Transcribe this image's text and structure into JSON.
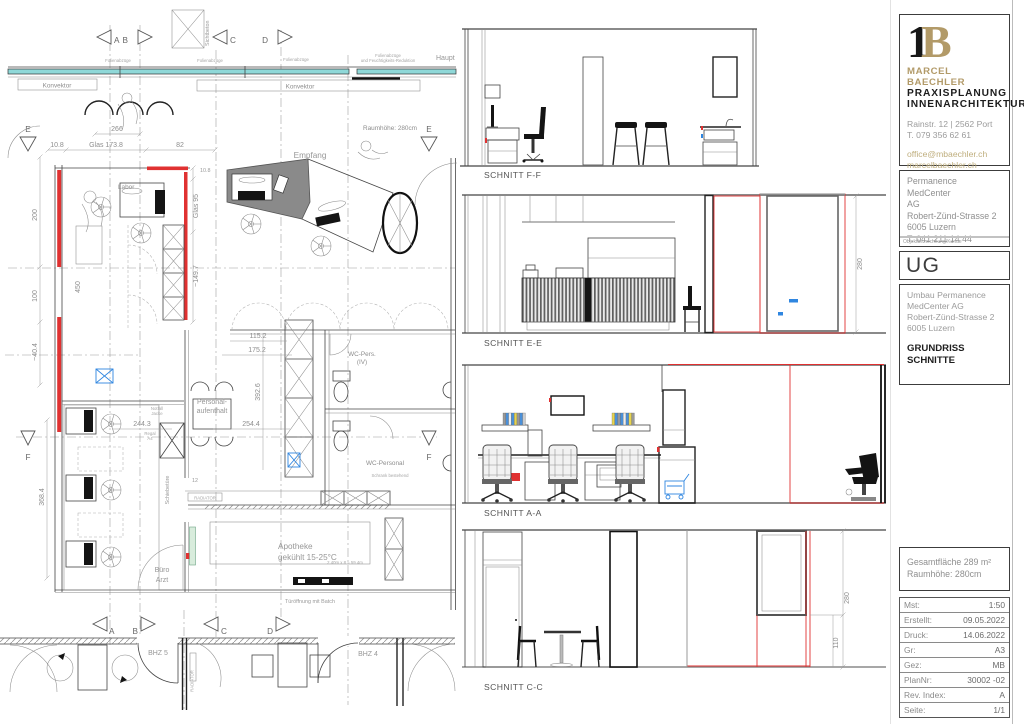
{
  "colors": {
    "accent_red": "#e03131",
    "window_teal": "#8fd8d8",
    "brand_gold": "#b29a68",
    "mark_blue": "#2f86e0"
  },
  "plan": {
    "markers": {
      "a": "A",
      "b": "B",
      "c": "C",
      "d": "D",
      "e": "E",
      "f": "F"
    },
    "labels": {
      "sichtbeton": "Sichtbeton",
      "folienabzuege": "Folienabzüge",
      "folien_sub": "und Feuchtigkeits-Reduktion",
      "haupt": "Haupt",
      "konvektor": "Konvektor",
      "raumhoehe": "Raumhöhe: 280cm",
      "empfang": "Empfang",
      "labor": "Labor",
      "personal_1": "Personal-",
      "personal_2": "aufenthalt",
      "wc_pers": "WC-Pers.",
      "wc_iv": "(IV)",
      "wc_personal": "WC-Personal",
      "schrank_bestehend": "Schrank bestehend",
      "schiebetuere": "Schiebetüre",
      "nr_12": "12",
      "radiator": "RADIATOR",
      "notfall_1": "Notfall",
      "notfall_2": "Jacke",
      "regal_1": "Regal",
      "regal_2": "A4",
      "buero_1": "Büro",
      "buero_2": "Arzt",
      "apotheke_1": "Apotheke",
      "apotheke_2": "gekühlt 15-25°C",
      "apotheke_calc": "2.40m x 8 = 59.4m",
      "tueroeffnung": "Türöffnung mit Batch",
      "bhz5": "BHZ 5",
      "bhz4": "BHZ 4"
    },
    "dims": {
      "d266": "266",
      "glas173": "Glas 173.8",
      "d108": "10.8",
      "d82": "82",
      "d108b": "10.8",
      "glas95": "Glas 95",
      "d1497": "~149.7",
      "d200": "200",
      "d100": "100",
      "d404": "~40.4",
      "d450": "450",
      "d3684": "368.4",
      "d2443": "244.3",
      "d1152": "115.2",
      "d1752": "175.2",
      "d3926": "392.6",
      "d2544": "254.4"
    }
  },
  "sections": {
    "ff": {
      "label": "SCHNITT F-F"
    },
    "ee": {
      "label": "SCHNITT E-E",
      "dim_height": "280"
    },
    "aa": {
      "label": "SCHNITT A-A"
    },
    "cc": {
      "label": "SCHNITT C-C",
      "dim_height": "280",
      "dim_sill": "110"
    }
  },
  "titleblock": {
    "logo_1": "1",
    "logo_b": "B",
    "firm_name": "MARCEL BAECHLER",
    "firm_line2": "PRAXISPLANUNG",
    "firm_line3": "INNENARCHITEKTUR",
    "firm_address": "Rainstr. 12 | 2562 Port",
    "firm_phone": "T. 079 356 62 61",
    "firm_email": "office@mbaechler.ch",
    "firm_web": "marcelbaechler.ch",
    "client_1": "Permanence MedCenter",
    "client_2": "AG",
    "client_3": "Robert-Zünd-Strasse 2",
    "client_4": "6005 Luzern",
    "client_5": "T: 041 211 14 44",
    "client_caption": "Objektbezeichnung/Kunde",
    "plan_code": "UG",
    "project_1": "Umbau Permanence",
    "project_2": "MedCenter AG",
    "project_3": "Robert-Zünd-Strasse 2",
    "project_4": "6005 Luzern",
    "drawing_title_1": "GRUNDRISS",
    "drawing_title_2": "SCHNITTE",
    "area_1": "Gesamtfläche 289 m²",
    "area_2": "Raumhöhe: 280cm",
    "meta": [
      {
        "label": "Mst:",
        "value": "1:50"
      },
      {
        "label": "Erstellt:",
        "value": "09.05.2022"
      },
      {
        "label": "Druck:",
        "value": "14.06.2022"
      },
      {
        "label": "Gr:",
        "value": "A3"
      },
      {
        "label": "Gez:",
        "value": "MB"
      },
      {
        "label": "PlanNr:",
        "value": "30002 -02"
      },
      {
        "label": "Rev. Index:",
        "value": "A"
      },
      {
        "label": "Seite:",
        "value": "1/1"
      }
    ]
  }
}
